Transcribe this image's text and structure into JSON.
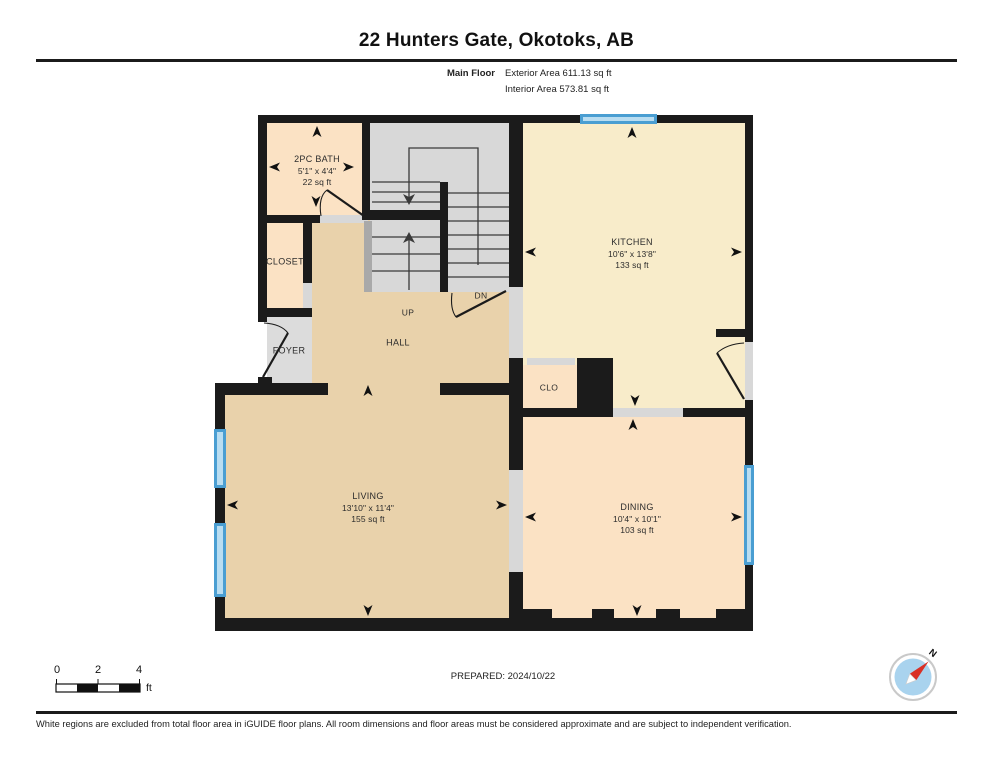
{
  "header": {
    "title": "22 Hunters Gate, Okotoks, AB",
    "floor_label": "Main Floor",
    "exterior_area": "Exterior Area 611.13 sq ft",
    "interior_area": "Interior Area 573.81 sq ft"
  },
  "rooms": {
    "bath": {
      "name": "2PC BATH",
      "dims": "5'1\" x 4'4\"",
      "area": "22 sq ft"
    },
    "closet": {
      "name": "CLOSET"
    },
    "foyer": {
      "name": "FOYER"
    },
    "hall": {
      "name": "HALL"
    },
    "clo": {
      "name": "CLO"
    },
    "kitchen": {
      "name": "KITCHEN",
      "dims": "10'6\" x 13'8\"",
      "area": "133 sq ft"
    },
    "living": {
      "name": "LIVING",
      "dims": "13'10\" x 11'4\"",
      "area": "155 sq ft"
    },
    "dining": {
      "name": "DINING",
      "dims": "10'4\" x 10'1\"",
      "area": "103 sq ft"
    }
  },
  "stairs": {
    "up_label": "UP",
    "down_label": "DN"
  },
  "footer": {
    "prepared_label": "PREPARED: 2024/10/22",
    "scale_ticks": [
      "0",
      "2",
      "4"
    ],
    "scale_unit": "ft",
    "compass_north": "N",
    "disclaimer": "White regions are excluded from total floor area in iGUIDE floor plans. All room dimensions and floor areas must be considered approximate and are subject to independent verification."
  },
  "colors": {
    "wall": "#1b1b1b",
    "floor_tan": "#e9d2ab",
    "floor_peach": "#fbe2c4",
    "floor_yellow": "#f8ecca",
    "floor_gray": "#dcdcdc",
    "stair_gray": "#d8d8d8",
    "window_blue": "#4a9ed2",
    "window_light": "#b9ddf1",
    "compass_red": "#d93026",
    "compass_blue": "#a9d3ee"
  }
}
